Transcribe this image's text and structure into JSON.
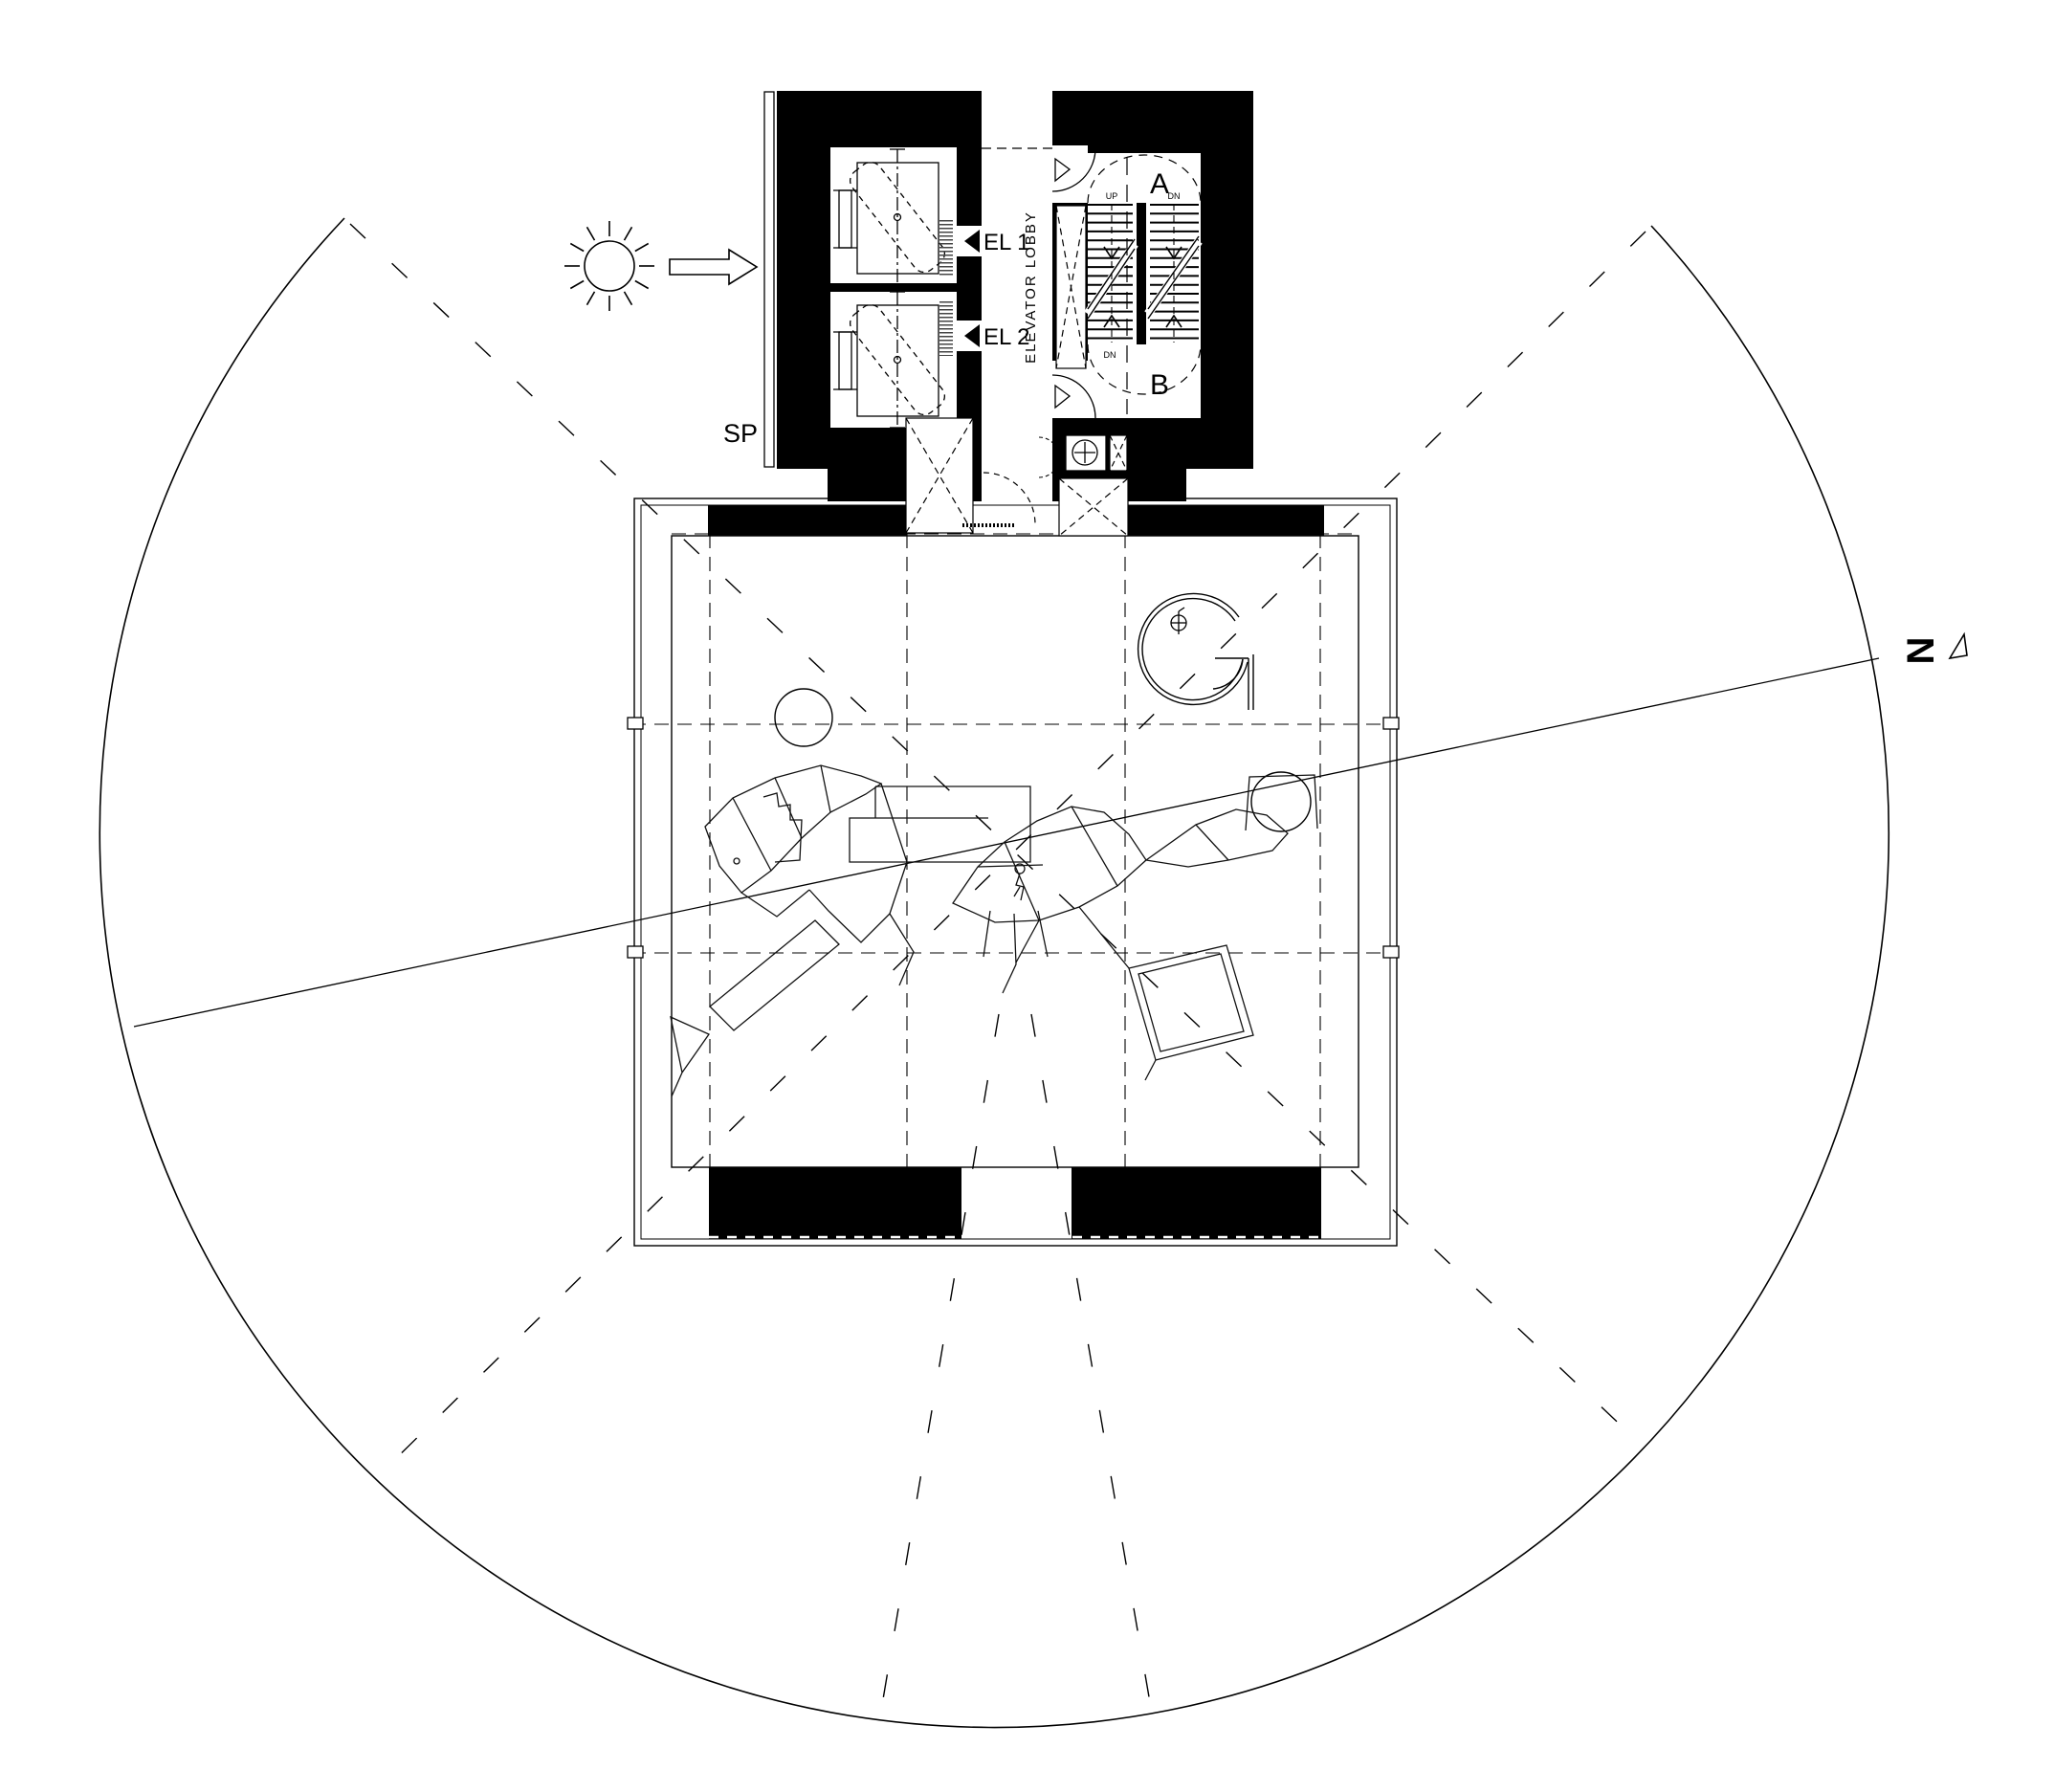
{
  "drawing": {
    "type": "architectural floor plan - tower observation level with service core",
    "labels": {
      "sp": "SP",
      "north": "N",
      "el1": "EL 1",
      "el2": "EL 2",
      "elevator_lobby": "ELEVATOR LOBBY",
      "stair_a": "A",
      "stair_b": "B",
      "stair_a_left": "UP",
      "stair_a_right": "DN",
      "stair_b_left": "DN",
      "stair_b_right": "UP"
    },
    "symbols": {
      "sun": "sun-icon",
      "light_direction": "light-direction-arrow-icon",
      "north_pointer": "north-arrow-icon",
      "elevator1_door": "door-triangle-icon",
      "elevator2_door": "door-triangle-icon",
      "wc_fixture": "toilet-plus-circle-icon",
      "shaft_cross": "shaft-x-icon",
      "survey_point": "circle-cross-icon"
    },
    "colors": {
      "ink": "#000000",
      "paper": "#ffffff",
      "hatch": "#444444"
    }
  }
}
